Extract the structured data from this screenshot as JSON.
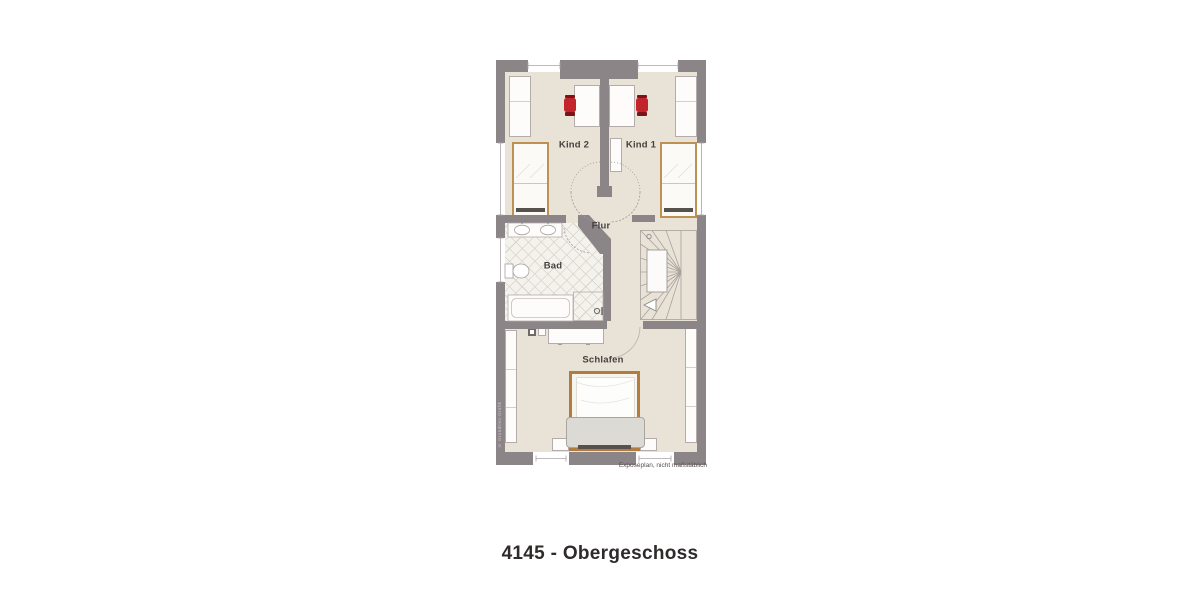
{
  "title": "4145 - Obergeschoss",
  "disclaimer": "Exposéplan, nicht maßstäblich",
  "watermark": "© Grundriss-Grafik",
  "rooms": {
    "kind2": "Kind 2",
    "kind1": "Kind 1",
    "flur": "Flur",
    "bad": "Bad",
    "schlafen": "Schlafen"
  },
  "colors": {
    "wall": "#8c8588",
    "floor": "#e9e3d7",
    "tile": "#f4f2ed",
    "tile_line": "#d8d3ca",
    "chair_red": "#c2252b",
    "bed_frame": "#bd9154",
    "double_bed_frame": "#b27c3e",
    "label_text": "#46413f"
  }
}
